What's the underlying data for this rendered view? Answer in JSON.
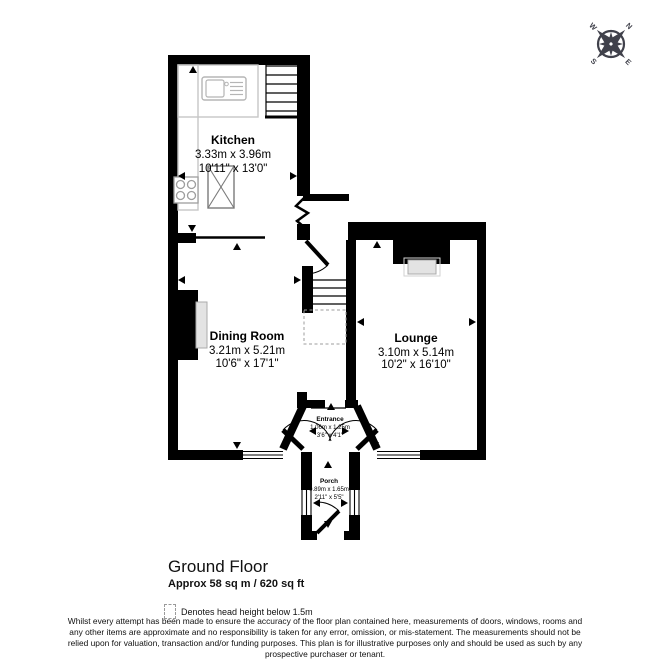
{
  "floor_plan": {
    "rooms": [
      {
        "name": "Kitchen",
        "metric": "3.33m x 3.96m",
        "imperial": "10'11\" x 13'0\""
      },
      {
        "name": "Dining Room",
        "metric": "3.21m x 5.21m",
        "imperial": "10'6\" x 17'1\""
      },
      {
        "name": "Lounge",
        "metric": "3.10m x 5.14m",
        "imperial": "10'2\" x 16'10\""
      },
      {
        "name": "Entrance",
        "metric": "1.06m x 1.25m",
        "imperial": "3'6\" x 4'1\""
      },
      {
        "name": "Porch",
        "metric": "0.89m x 1.65m",
        "imperial": "2'11\" x 5'5\""
      }
    ],
    "compass": {
      "north": "N",
      "east": "E",
      "south": "S",
      "west": "W"
    },
    "footer": {
      "floor_title": "Ground Floor",
      "floor_area": "Approx 58 sq m / 620 sq ft",
      "legend_text": "Denotes head height below 1.5m",
      "disclaimer_lines": [
        "Whilst every attempt has been made to ensure the accuracy of the floor plan contained here, measurements of doors, windows, rooms and",
        "any other items are approximate and no responsibility is taken for any error, omission, or mis-statement. The measurements should not be",
        "relied upon for valuation, transaction and/or funding purposes. This plan is for illustrative purposes only and should be used as such by any",
        "prospective purchaser or tenant."
      ]
    },
    "colors": {
      "wall": "#000000",
      "fixture": "#c6c6c6",
      "compass": "#40414b"
    }
  }
}
